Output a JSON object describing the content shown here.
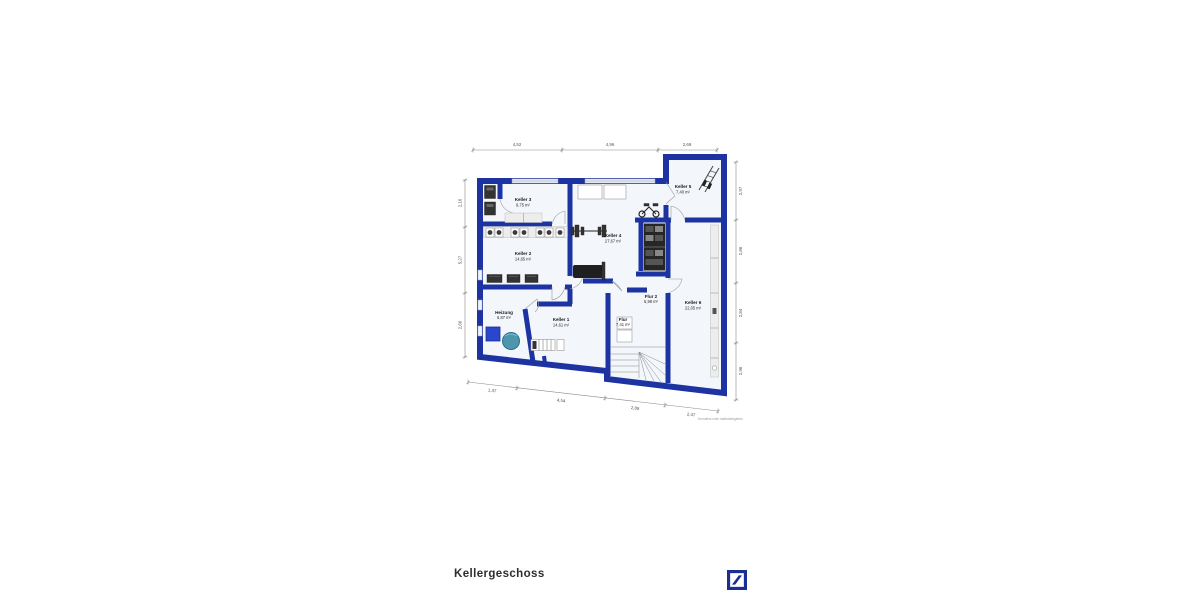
{
  "page": {
    "title": "Kellergeschoss",
    "watermark": "Grundriss nicht maßstabsgetreu"
  },
  "plan": {
    "colors": {
      "wall": "#1d33a2",
      "floor": "#f3f6fb",
      "logo": "#1b2f92",
      "boiler": "#4e96ad",
      "tank": "#2a47cc"
    },
    "rooms": {
      "keller1": {
        "name": "Keller 1",
        "area": "14,61 m²"
      },
      "keller2": {
        "name": "Keller 2",
        "area": "14,65 m²"
      },
      "keller3": {
        "name": "Keller 3",
        "area": "9,75 m²"
      },
      "keller4": {
        "name": "Keller 4",
        "area": "27,67 m²"
      },
      "keller5": {
        "name": "Keller 5",
        "area": "7,40 m²"
      },
      "keller6": {
        "name": "Keller 6",
        "area": "22,05 m²"
      },
      "flur": {
        "name": "Flur",
        "area": "7,41 m²"
      },
      "flur2": {
        "name": "Flur 2",
        "area": "5,98 m²"
      },
      "heizung": {
        "name": "Heizung",
        "area": "6,87 m²"
      }
    },
    "dimensions": {
      "top": [
        "4,52",
        "4,96",
        "2,69"
      ],
      "left": [
        "2,16",
        "5,27",
        "2,60"
      ],
      "right": [
        "2,97",
        "2,86",
        "2,84",
        "2,96"
      ],
      "bottom": [
        "1,37",
        "4,54",
        "2,88",
        "2,47"
      ]
    }
  }
}
